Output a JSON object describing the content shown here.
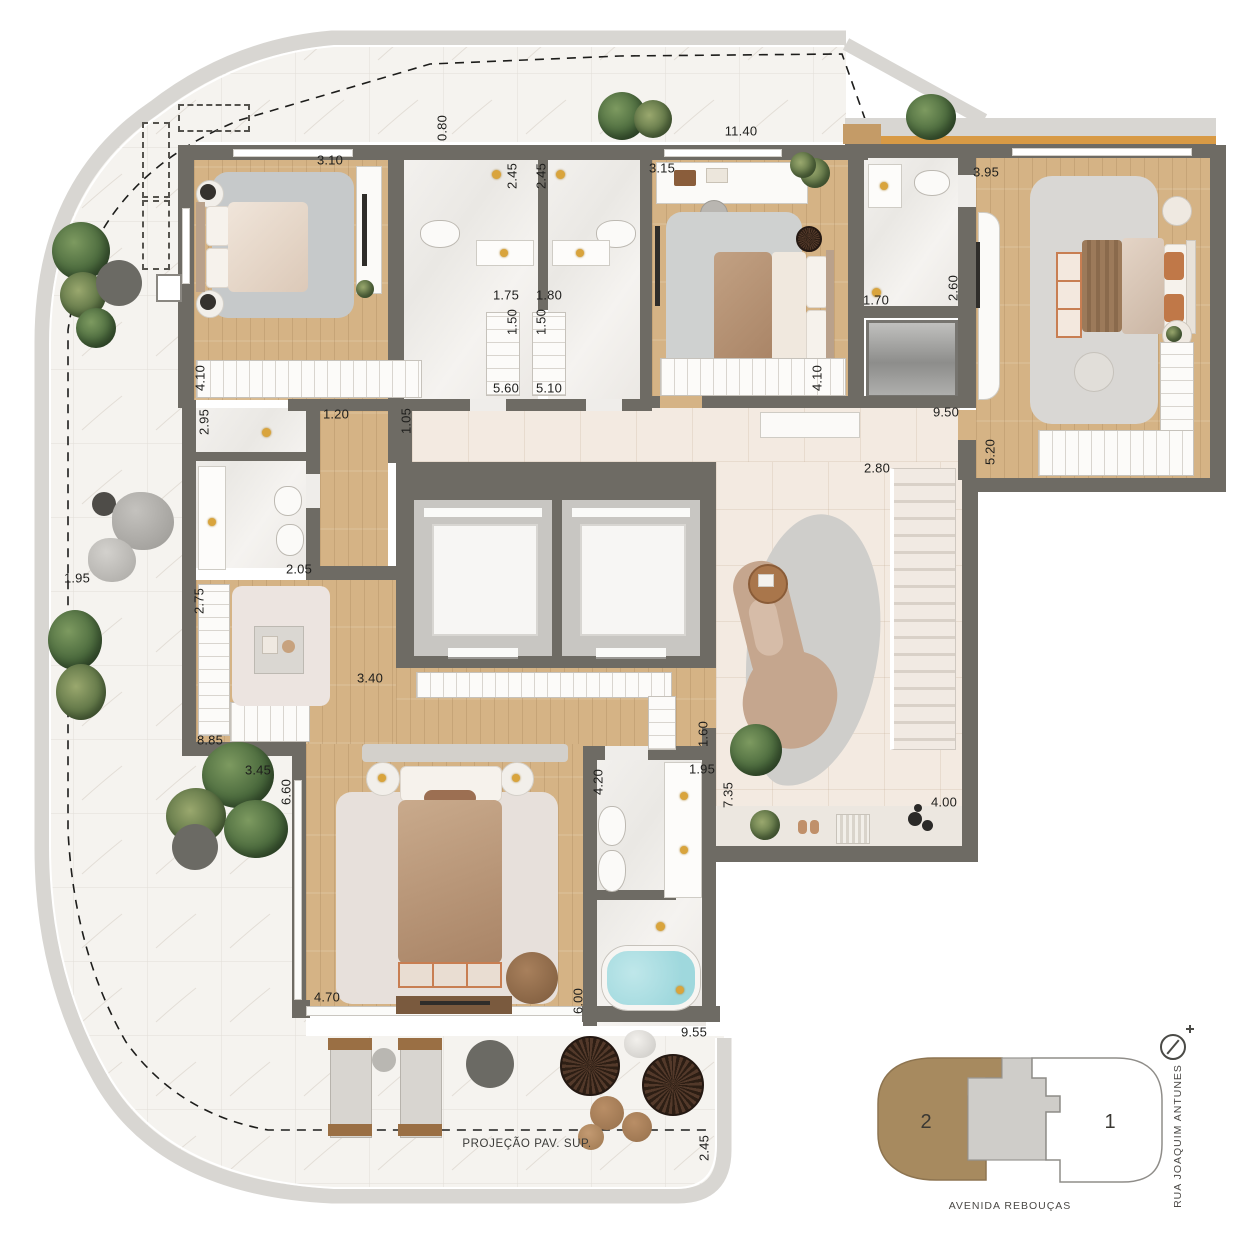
{
  "plan": {
    "projection_label": "PROJEÇÃO PAV. SUP.",
    "dimensions": [
      {
        "t": "0.80",
        "x": 442,
        "y": 128,
        "v": 1
      },
      {
        "t": "3.10",
        "x": 330,
        "y": 160
      },
      {
        "t": "2.45",
        "x": 512,
        "y": 176,
        "v": 1
      },
      {
        "t": "2.45",
        "x": 541,
        "y": 176,
        "v": 1
      },
      {
        "t": "3.15",
        "x": 662,
        "y": 168
      },
      {
        "t": "11.40",
        "x": 741,
        "y": 131
      },
      {
        "t": "3.95",
        "x": 986,
        "y": 172
      },
      {
        "t": "1.75",
        "x": 506,
        "y": 295
      },
      {
        "t": "1.80",
        "x": 549,
        "y": 295
      },
      {
        "t": "1.70",
        "x": 876,
        "y": 300
      },
      {
        "t": "2.60",
        "x": 953,
        "y": 288,
        "v": 1
      },
      {
        "t": "1.50",
        "x": 512,
        "y": 322,
        "v": 1
      },
      {
        "t": "1.50",
        "x": 541,
        "y": 322,
        "v": 1
      },
      {
        "t": "4.10",
        "x": 200,
        "y": 378,
        "v": 1
      },
      {
        "t": "5.60",
        "x": 506,
        "y": 388
      },
      {
        "t": "5.10",
        "x": 549,
        "y": 388
      },
      {
        "t": "4.10",
        "x": 817,
        "y": 378,
        "v": 1
      },
      {
        "t": "9.50",
        "x": 946,
        "y": 412
      },
      {
        "t": "5.20",
        "x": 990,
        "y": 452,
        "v": 1
      },
      {
        "t": "2.95",
        "x": 204,
        "y": 422,
        "v": 1
      },
      {
        "t": "1.20",
        "x": 336,
        "y": 414
      },
      {
        "t": "1.05",
        "x": 406,
        "y": 421,
        "v": 1
      },
      {
        "t": "2.80",
        "x": 877,
        "y": 468
      },
      {
        "t": "2.05",
        "x": 299,
        "y": 569
      },
      {
        "t": "1.95",
        "x": 77,
        "y": 578
      },
      {
        "t": "2.75",
        "x": 199,
        "y": 601,
        "v": 1
      },
      {
        "t": "3.40",
        "x": 370,
        "y": 678
      },
      {
        "t": "8.85",
        "x": 210,
        "y": 740
      },
      {
        "t": "1.60",
        "x": 703,
        "y": 734,
        "v": 1
      },
      {
        "t": "3.45",
        "x": 258,
        "y": 770
      },
      {
        "t": "6.60",
        "x": 286,
        "y": 792,
        "v": 1
      },
      {
        "t": "4.20",
        "x": 598,
        "y": 782,
        "v": 1
      },
      {
        "t": "1.95",
        "x": 702,
        "y": 769
      },
      {
        "t": "7.35",
        "x": 728,
        "y": 795,
        "v": 1
      },
      {
        "t": "4.00",
        "x": 944,
        "y": 802
      },
      {
        "t": "6.00",
        "x": 578,
        "y": 1001,
        "v": 1
      },
      {
        "t": "4.70",
        "x": 327,
        "y": 997
      },
      {
        "t": "9.55",
        "x": 694,
        "y": 1032
      },
      {
        "t": "2.45",
        "x": 704,
        "y": 1148,
        "v": 1
      }
    ]
  },
  "keyplan": {
    "unit_highlighted": "2",
    "unit_other": "1",
    "street_bottom": "AVENIDA REBOUÇAS",
    "street_side": "RUA JOAQUIM ANTUNES"
  },
  "colors": {
    "wall": "#6e6b64",
    "wood_floor": "#d5b385",
    "marble_floor": "#f1efec",
    "tile_floor": "#f3eae1",
    "terrace": "#f5f3ef",
    "slab_edge": "#d8d6d2",
    "balcony_rail": "#d89a45",
    "keyplan_unit2": "#a78a5f",
    "tub_water": "#9fd8dd",
    "rug_gray": "#c9cac9",
    "rug_cream": "#e7e0db",
    "sofa": "#c5a68e",
    "greenery": "#4c6b3e"
  }
}
